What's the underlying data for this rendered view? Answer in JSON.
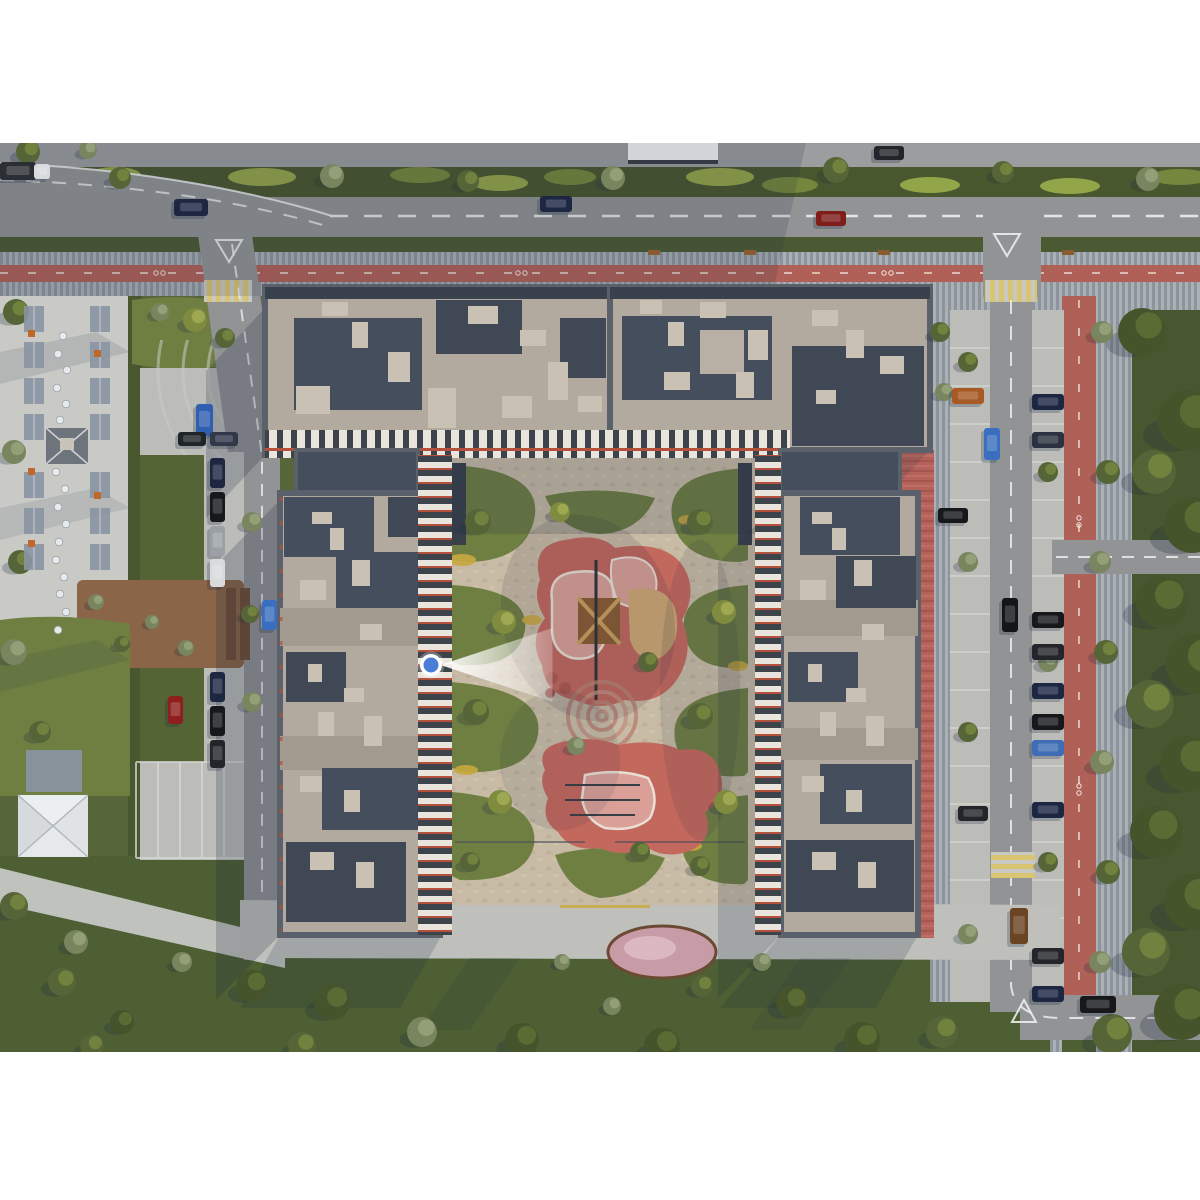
{
  "scene": {
    "kind": "aerial-masterplan-render",
    "letterbox_top_px": 143,
    "letterbox_bottom_px": 1052
  },
  "palette": {
    "bg": "#ffffff",
    "grass": "#57663a",
    "grass_south": "#4d5f33",
    "grass_right": "#47572f",
    "hedge": "#49572e",
    "verge": "#4c5a33",
    "road": "#919395",
    "road_top": "#9b9d9e",
    "road_line": "#eceeee",
    "paver": "#a9b0b6",
    "paver_stripe": "#8d949c",
    "bike_lane": "#b06157",
    "bike_line": "#f0e8e0",
    "crosswalk_yellow": "#d9c471",
    "crosswalk_bg": "#c9c9c4",
    "plaza": "#c9cac6",
    "parking": "#bcbdb9",
    "parking_line": "#d8d9d5",
    "courtyard": "#c8bba5",
    "island": "#6f7f42",
    "island_dark": "#556434",
    "flower_yellow": "#c9a83f",
    "play_red": "#c2685d",
    "play_pink": "#daa097",
    "play_white": "#eadfd4",
    "sand": "#cfa873",
    "ring_paving": "#b98170",
    "roof": "#b2aa9f",
    "roof_dark": "#454e5c",
    "roof_darker": "#3f4854",
    "roof_box": "#c9c1b4",
    "roof_concrete": "#a29a8e",
    "parapet": "#5b616b",
    "facade_dark": "#3c434b",
    "facade_white": "#e9e5dd",
    "facade_red": "#b5503c",
    "red_paving": "#b4625a",
    "deck": "#8a6547",
    "deck_dark": "#6f4f36",
    "pergola": "#8a94a2",
    "umbrella": "#eceff1",
    "umbrella_seam": "#b2b8bd",
    "table": "#e8e9ea",
    "shadow": "#1e2a40",
    "flowerbed_pink": "#c79ca6",
    "bench": "#8a5a30",
    "accent_orange": "#c06828"
  },
  "marker": {
    "cx": 431,
    "cy": 665,
    "r": 7.5,
    "ring": 3.5,
    "color": "#4a7dd6",
    "ring_color": "#ffffff",
    "cone_length": 112,
    "cone_half_width": 37,
    "direction": "east"
  },
  "landscape": {
    "trees": {
      "types": {
        "dark": {
          "base": "#46542c",
          "light": "#5f7036"
        },
        "mid": {
          "base": "#566537",
          "light": "#75873f"
        },
        "sage": {
          "base": "#79855f",
          "light": "#98a37b"
        },
        "yellow": {
          "base": "#7f8b3f",
          "light": "#a3ab55"
        }
      },
      "items": [
        [
          120,
          178,
          11,
          "mid"
        ],
        [
          332,
          176,
          12,
          "sage"
        ],
        [
          468,
          181,
          11,
          "mid"
        ],
        [
          613,
          178,
          12,
          "sage"
        ],
        [
          836,
          170,
          13,
          "mid"
        ],
        [
          1003,
          172,
          11,
          "mid"
        ],
        [
          1148,
          179,
          12,
          "sage"
        ],
        [
          28,
          152,
          12,
          "mid"
        ],
        [
          88,
          150,
          9,
          "sage"
        ],
        [
          195,
          320,
          12,
          "yellow"
        ],
        [
          225,
          338,
          10,
          "mid"
        ],
        [
          160,
          312,
          9,
          "sage"
        ],
        [
          1142,
          332,
          24,
          "dark"
        ],
        [
          1188,
          420,
          30,
          "dark"
        ],
        [
          1154,
          472,
          22,
          "mid"
        ],
        [
          1192,
          525,
          28,
          "dark"
        ],
        [
          1162,
          602,
          26,
          "dark"
        ],
        [
          1196,
          664,
          30,
          "dark"
        ],
        [
          1150,
          704,
          24,
          "mid"
        ],
        [
          1188,
          764,
          28,
          "dark"
        ],
        [
          1156,
          832,
          26,
          "dark"
        ],
        [
          1192,
          902,
          28,
          "dark"
        ],
        [
          1146,
          952,
          24,
          "mid"
        ],
        [
          1182,
          1012,
          28,
          "dark"
        ],
        [
          1112,
          1034,
          20,
          "mid"
        ],
        [
          1102,
          332,
          11,
          "sage"
        ],
        [
          1108,
          472,
          12,
          "mid"
        ],
        [
          1100,
          562,
          11,
          "sage"
        ],
        [
          1106,
          652,
          12,
          "mid"
        ],
        [
          1102,
          762,
          12,
          "sage"
        ],
        [
          1108,
          872,
          12,
          "mid"
        ],
        [
          1100,
          962,
          11,
          "sage"
        ],
        [
          968,
          362,
          10,
          "mid"
        ],
        [
          968,
          562,
          10,
          "sage"
        ],
        [
          968,
          732,
          10,
          "mid"
        ],
        [
          968,
          934,
          10,
          "sage"
        ],
        [
          1048,
          472,
          10,
          "mid"
        ],
        [
          1048,
          662,
          10,
          "sage"
        ],
        [
          1048,
          862,
          10,
          "mid"
        ],
        [
          16,
          312,
          13,
          "mid"
        ],
        [
          14,
          452,
          12,
          "sage"
        ],
        [
          20,
          562,
          12,
          "mid"
        ],
        [
          14,
          652,
          13,
          "sage"
        ],
        [
          40,
          732,
          11,
          "mid"
        ],
        [
          14,
          906,
          14,
          "mid"
        ],
        [
          76,
          942,
          12,
          "sage"
        ],
        [
          252,
          522,
          10,
          "sage"
        ],
        [
          250,
          614,
          9,
          "mid"
        ],
        [
          252,
          702,
          10,
          "sage"
        ],
        [
          96,
          602,
          8,
          "sage"
        ],
        [
          122,
          644,
          8,
          "mid"
        ],
        [
          152,
          622,
          7,
          "sage"
        ],
        [
          186,
          648,
          8,
          "sage"
        ],
        [
          478,
          522,
          13,
          "mid"
        ],
        [
          504,
          622,
          12,
          "yellow"
        ],
        [
          476,
          712,
          13,
          "mid"
        ],
        [
          500,
          802,
          12,
          "yellow"
        ],
        [
          470,
          862,
          10,
          "mid"
        ],
        [
          700,
          522,
          13,
          "mid"
        ],
        [
          724,
          612,
          12,
          "yellow"
        ],
        [
          700,
          716,
          13,
          "mid"
        ],
        [
          726,
          802,
          12,
          "yellow"
        ],
        [
          700,
          866,
          10,
          "mid"
        ],
        [
          560,
          512,
          10,
          "yellow"
        ],
        [
          648,
          662,
          10,
          "mid"
        ],
        [
          576,
          746,
          9,
          "sage"
        ],
        [
          640,
          852,
          10,
          "mid"
        ],
        [
          252,
          986,
          16,
          "dark"
        ],
        [
          332,
          1002,
          18,
          "dark"
        ],
        [
          422,
          1032,
          15,
          "sage"
        ],
        [
          302,
          1046,
          14,
          "mid"
        ],
        [
          522,
          1040,
          17,
          "dark"
        ],
        [
          612,
          1006,
          9,
          "sage"
        ],
        [
          662,
          1046,
          18,
          "dark"
        ],
        [
          702,
          986,
          11,
          "mid"
        ],
        [
          792,
          1002,
          16,
          "dark"
        ],
        [
          862,
          1040,
          18,
          "dark"
        ],
        [
          942,
          1032,
          16,
          "mid"
        ],
        [
          562,
          962,
          8,
          "sage"
        ],
        [
          762,
          962,
          9,
          "sage"
        ],
        [
          62,
          982,
          14,
          "mid"
        ],
        [
          122,
          1022,
          12,
          "dark"
        ],
        [
          182,
          962,
          10,
          "sage"
        ],
        [
          92,
          1046,
          12,
          "mid"
        ],
        [
          940,
          332,
          10,
          "mid"
        ],
        [
          944,
          392,
          9,
          "sage"
        ]
      ]
    }
  },
  "vehicles": [
    [
      174,
      199,
      34,
      17,
      "#1d2742"
    ],
    [
      540,
      196,
      32,
      16,
      "#1d2742"
    ],
    [
      816,
      211,
      30,
      15,
      "#7e1d1a"
    ],
    [
      874,
      146,
      30,
      14,
      "#23252a"
    ],
    [
      0,
      162,
      36,
      18,
      "#2b2e33"
    ],
    [
      34,
      164,
      16,
      15,
      "#d8dadb"
    ],
    [
      196,
      404,
      17,
      32,
      "#2f5fb0"
    ],
    [
      262,
      600,
      15,
      30,
      "#3a6fc0"
    ],
    [
      178,
      432,
      28,
      14,
      "#1f2428"
    ],
    [
      210,
      432,
      28,
      14,
      "#30384a"
    ],
    [
      210,
      458,
      15,
      30,
      "#1d2742"
    ],
    [
      210,
      492,
      15,
      30,
      "#17181c"
    ],
    [
      210,
      526,
      15,
      30,
      "#9aa0a6"
    ],
    [
      210,
      559,
      15,
      28,
      "#d8dadb"
    ],
    [
      210,
      672,
      15,
      30,
      "#1d2742"
    ],
    [
      210,
      706,
      15,
      30,
      "#17181c"
    ],
    [
      168,
      696,
      15,
      28,
      "#8e1f1c"
    ],
    [
      210,
      740,
      15,
      28,
      "#23252a"
    ],
    [
      952,
      388,
      32,
      16,
      "#a85a24"
    ],
    [
      938,
      508,
      30,
      15,
      "#17181c"
    ],
    [
      958,
      806,
      30,
      15,
      "#23252a"
    ],
    [
      984,
      428,
      16,
      32,
      "#3a6fc0"
    ],
    [
      1032,
      394,
      32,
      16,
      "#1d2742"
    ],
    [
      1032,
      432,
      32,
      16,
      "#2a3140"
    ],
    [
      1032,
      612,
      32,
      16,
      "#17181c"
    ],
    [
      1032,
      644,
      32,
      16,
      "#23252a"
    ],
    [
      1032,
      683,
      32,
      16,
      "#1d2742"
    ],
    [
      1032,
      714,
      32,
      16,
      "#17181c"
    ],
    [
      1032,
      740,
      32,
      16,
      "#3f6db5"
    ],
    [
      1032,
      802,
      32,
      16,
      "#1d2742"
    ],
    [
      1032,
      948,
      32,
      16,
      "#23252a"
    ],
    [
      1032,
      986,
      32,
      16,
      "#1d2742"
    ],
    [
      1002,
      598,
      16,
      34,
      "#141518"
    ],
    [
      1010,
      908,
      18,
      36,
      "#6b4423"
    ],
    [
      1080,
      996,
      36,
      17,
      "#17181c"
    ]
  ],
  "plaza": {
    "tables": [
      [
        63,
        336
      ],
      [
        58,
        354
      ],
      [
        67,
        370
      ],
      [
        57,
        388
      ],
      [
        66,
        404
      ],
      [
        60,
        420
      ],
      [
        56,
        472
      ],
      [
        65,
        489
      ],
      [
        58,
        507
      ],
      [
        66,
        524
      ],
      [
        59,
        542
      ],
      [
        56,
        560
      ],
      [
        64,
        577
      ],
      [
        60,
        594
      ],
      [
        66,
        612
      ],
      [
        58,
        630
      ]
    ],
    "pergola_columns": {
      "xs": [
        24,
        90
      ],
      "ys": [
        306,
        342,
        378,
        414,
        472,
        508,
        544
      ],
      "w": 20,
      "h": 26
    },
    "accents": [
      [
        28,
        330
      ],
      [
        94,
        350
      ],
      [
        28,
        468
      ],
      [
        94,
        492
      ],
      [
        28,
        540
      ]
    ]
  },
  "benches": [
    [
      648,
      250
    ],
    [
      744,
      250
    ],
    [
      878,
      250
    ],
    [
      1062,
      250
    ]
  ]
}
